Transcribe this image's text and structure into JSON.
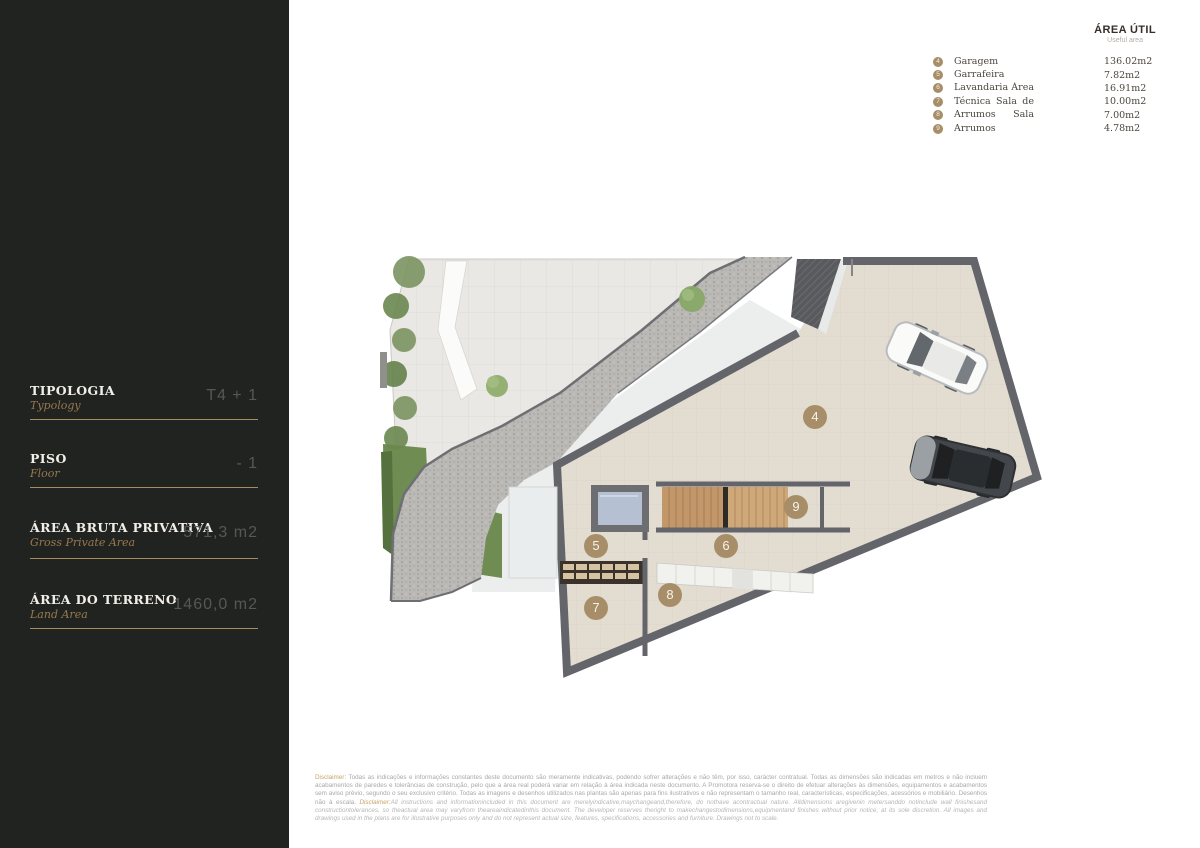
{
  "colors": {
    "sidebar_bg": "#212321",
    "accent_gold": "#a98c5d",
    "marker_tan": "#a78e68",
    "legend_text": "#4c463f",
    "disclaimer_gray": "#a8a8a8"
  },
  "sidebar": {
    "sections": [
      {
        "label": "TIPOLOGIA",
        "sublabel": "Typology",
        "value": "T4 + 1"
      },
      {
        "label": "PISO",
        "sublabel": "Floor",
        "value": "- 1"
      },
      {
        "label": "ÁREA BRUTA PRIVATIVA",
        "sublabel": "Gross Private Area",
        "value": "571,3 m2"
      },
      {
        "label": "ÁREA DO TERRENO",
        "sublabel": "Land Area",
        "value": "1460,0 m2"
      }
    ]
  },
  "legend": {
    "title": "ÁREA ÚTIL",
    "subtitle": "Useful area",
    "items": [
      {
        "num": "4",
        "label": "Garagem",
        "value": "136.02m2"
      },
      {
        "num": "5",
        "label": "Garrafeira",
        "value": "7.82m2"
      },
      {
        "num": "6",
        "label": "Lavandaria Área",
        "value": "16.91m2"
      },
      {
        "num": "7",
        "label": "Técnica Sala de",
        "value": "10.00m2"
      },
      {
        "num": "8",
        "label": "Arrumos Sala de",
        "value": "7.00m2"
      },
      {
        "num": "9",
        "label": "Arrumos",
        "value": "4.78m2"
      }
    ]
  },
  "plan": {
    "markers": [
      {
        "num": "4",
        "x": 815,
        "y": 417
      },
      {
        "num": "5",
        "x": 596,
        "y": 546
      },
      {
        "num": "6",
        "x": 726,
        "y": 546
      },
      {
        "num": "7",
        "x": 596,
        "y": 608
      },
      {
        "num": "8",
        "x": 670,
        "y": 595
      },
      {
        "num": "9",
        "x": 796,
        "y": 507
      }
    ]
  },
  "disclaimer": {
    "pt_label": "Disclaimer:",
    "pt": " Todas as indicações e informações constantes deste documento são meramente indicativas, podendo sofrer alterações e não têm, por isso, carácter contratual. Todas as dimensões são indicadas em metros e não incluem acabamentos de paredes e tolerâncias de construção, pelo que a área real poderá variar em relação à área indicada neste documento. A Promotora reserva-se o direito de efetuar alterações às dimensões, equipamentos e acabamentos sem aviso prévio, segundo o seu exclusivo critério. Todas as imagens e desenhos utilizados nas plantas são apenas para fins ilustrativos e não representam o tamanho real, características, especificações, acessórios e mobiliário. Desenhos não à escala. ",
    "en_label": "Disclaimer:",
    "en": "All instructions and informationincluded in this document are merelyindicative,maychangeand,therefore, do nothave acontractual nature. Alldimensions aregivenin metersanddo notinclude wall finishesand constructiontolerances, so theactual area may varyfrom theareaindicatedinthis document. The developer reserves theright to makechangestodimensions,equipmentand finishes without prior notice, at its sole discretion. All images and drawings used in the plans are for illustrative purposes only and do not represent actual size, features, specifications, accessories and furniture. Drawings not to scale."
  }
}
